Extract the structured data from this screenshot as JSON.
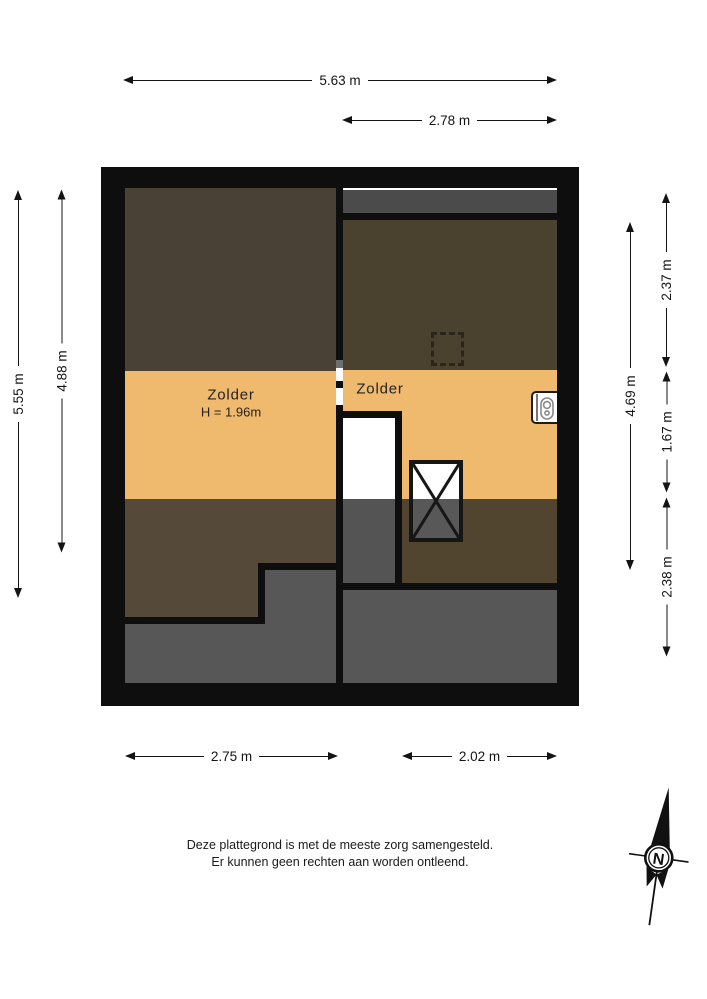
{
  "plan": {
    "rooms": {
      "left": {
        "label": "Zolder",
        "height_note": "H = 1.96m"
      },
      "right": {
        "label": "Zolder"
      }
    }
  },
  "dimensions": {
    "top_total": "5.63 m",
    "top_right_room": "2.78 m",
    "left_outer": "5.55 m",
    "left_inner": "4.88 m",
    "right_inner_total": "4.69 m",
    "right_top": "2.37 m",
    "right_middle": "1.67 m",
    "right_bottom": "2.38 m",
    "bottom_left_room": "2.75 m",
    "bottom_right_room": "2.02 m"
  },
  "footer": {
    "line1": "Deze plattegrond is met de meeste zorg samengesteld.",
    "line2": "Er kunnen geen rechten aan worden ontleend."
  },
  "compass": {
    "north_label": "N"
  },
  "colors": {
    "wall": "#0e0e0e",
    "tan": "#efb96e",
    "brown-lt": "#4a4136",
    "brown-lb": "#55493a",
    "brown-rt": "#4a422f",
    "brown-rb": "#51452f",
    "gray": "#575757",
    "gray-strip": "#4b4b4b",
    "gray-stair": "#545454"
  }
}
